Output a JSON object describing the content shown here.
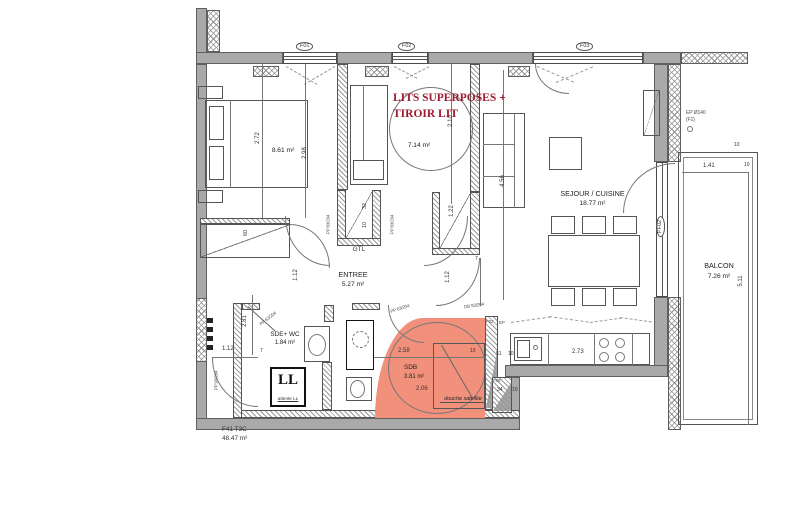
{
  "colors": {
    "highlight": "#f1917b",
    "annotation": "#9c1b30",
    "wall_gray": "#a9a9a9"
  },
  "apartment": {
    "code": "F41 T3C",
    "total_area": "48.47 m²"
  },
  "annotation": {
    "line1": "LITS SUPERPOSES +",
    "line2": "TIROIR LIT"
  },
  "rooms": {
    "bedroom1": {
      "area": "8.61 m²"
    },
    "bedroom2": {
      "area": "7.14 m²"
    },
    "sejour": {
      "name": "SEJOUR / CUISINE",
      "area": "18.77 m²"
    },
    "balcon": {
      "name": "BALCON",
      "area": "7.26 m²"
    },
    "entree": {
      "name": "ENTREE",
      "area": "5.27 m²"
    },
    "sde_wc": {
      "name": "SDE+ WC",
      "area": "1.84 m²"
    },
    "sdb": {
      "name": "SDB",
      "area": "3.81 m²",
      "note": "douche satellite"
    }
  },
  "fixtures": {
    "gtl": "GTL",
    "ll": "LL",
    "ll_note": "attente LL",
    "ep_line1": "EP Ø140",
    "ep_line2": "(F1)"
  },
  "openings": {
    "f01": "F01",
    "f02": "F02",
    "f03": "F03",
    "pf02": "PF02",
    "pp83_left": "PP 83/204",
    "pp83_right": "PP 83/204",
    "pp63_sde": "PP 63/204",
    "pp63_sdb": "PP 63/204",
    "pp93": "PP 93/204",
    "db93": "DB 93/204",
    "gaine_f02": "F02",
    "gaine_ep": "EP",
    "gaine_f08": "F08"
  },
  "dimensions": {
    "bed1_w": "2.72",
    "bed1_l": "2.98",
    "bed2_d": "2.10",
    "sejour_h": "4.56",
    "balcon_w": "1.41",
    "balcon_d": "5.11",
    "balcon_t1": "10",
    "balcon_t2": "10",
    "corridor": "2.81",
    "door1": "1.12",
    "door2": "1.12",
    "door3": "1.12",
    "t7a": "7",
    "t7b": "7",
    "closet_depth": "60",
    "gtl_d1": "32",
    "gtl_d2": "10",
    "closet2_h": "1.22",
    "sdb_w": "2.58",
    "sdb_t": "10",
    "sdb_h": "2.06",
    "g51": "51",
    "g10": "10",
    "g34": "34",
    "g10b": "10",
    "kitchen_w": "2.73"
  }
}
